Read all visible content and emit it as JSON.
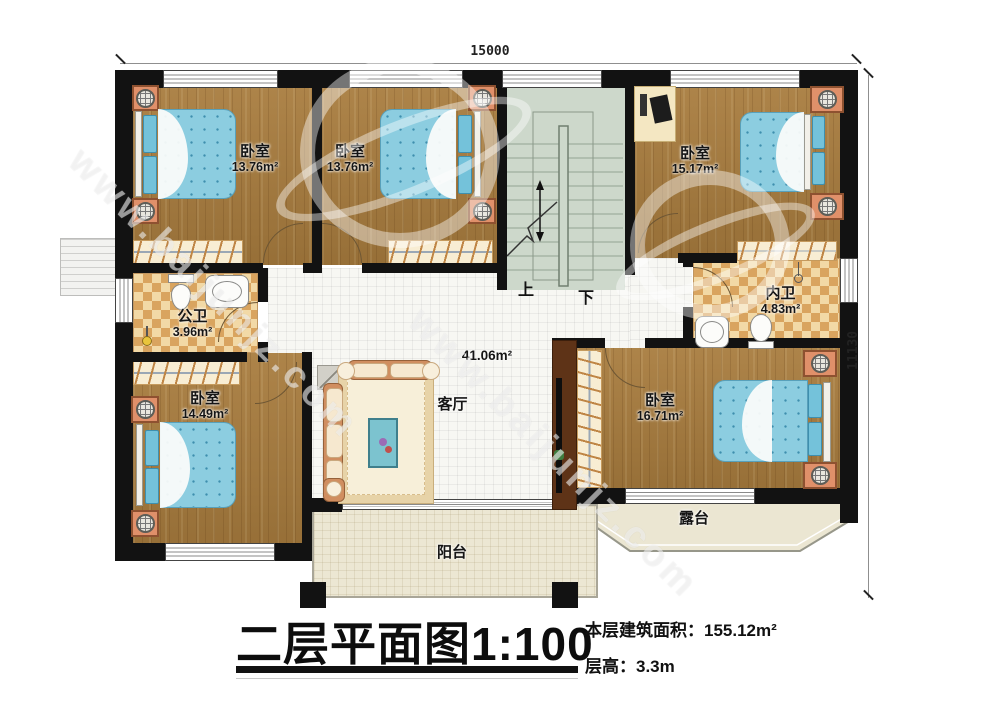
{
  "dimensions": {
    "width_mm": "15000",
    "height_mm": "11130"
  },
  "rooms": {
    "bedroom_top_left": {
      "label": "卧室",
      "area": "13.76m²"
    },
    "bedroom_top_mid": {
      "label": "卧室",
      "area": "13.76m²"
    },
    "bedroom_top_right": {
      "label": "卧室",
      "area": "15.17m²"
    },
    "bedroom_bottom_left": {
      "label": "卧室",
      "area": "14.49m²"
    },
    "bedroom_bottom_right": {
      "label": "卧室",
      "area": "16.71m²"
    },
    "bath_public": {
      "label": "公卫",
      "area": "3.96m²"
    },
    "bath_ensuite": {
      "label": "内卫",
      "area": "4.83m²"
    },
    "living_room": {
      "label": "客厅",
      "area": "41.06m²"
    },
    "balcony": {
      "label": "阳台"
    },
    "terrace": {
      "label": "露台"
    }
  },
  "stairs": {
    "up_label": "上",
    "down_label": "下"
  },
  "title": {
    "main": "二层平面图1:100",
    "floor_area_label": "本层建筑面积：",
    "floor_area_value": "155.12m²",
    "floor_height_label": "层高：",
    "floor_height_value": "3.3m"
  },
  "watermark": {
    "text": "www.baijunjz.com"
  },
  "colors": {
    "wall": "#121212",
    "wood": "#a87c3e",
    "bed_blue": "#8ccde0",
    "stair_green": "#cdd8cb",
    "checker_dark": "#d9a45f"
  }
}
